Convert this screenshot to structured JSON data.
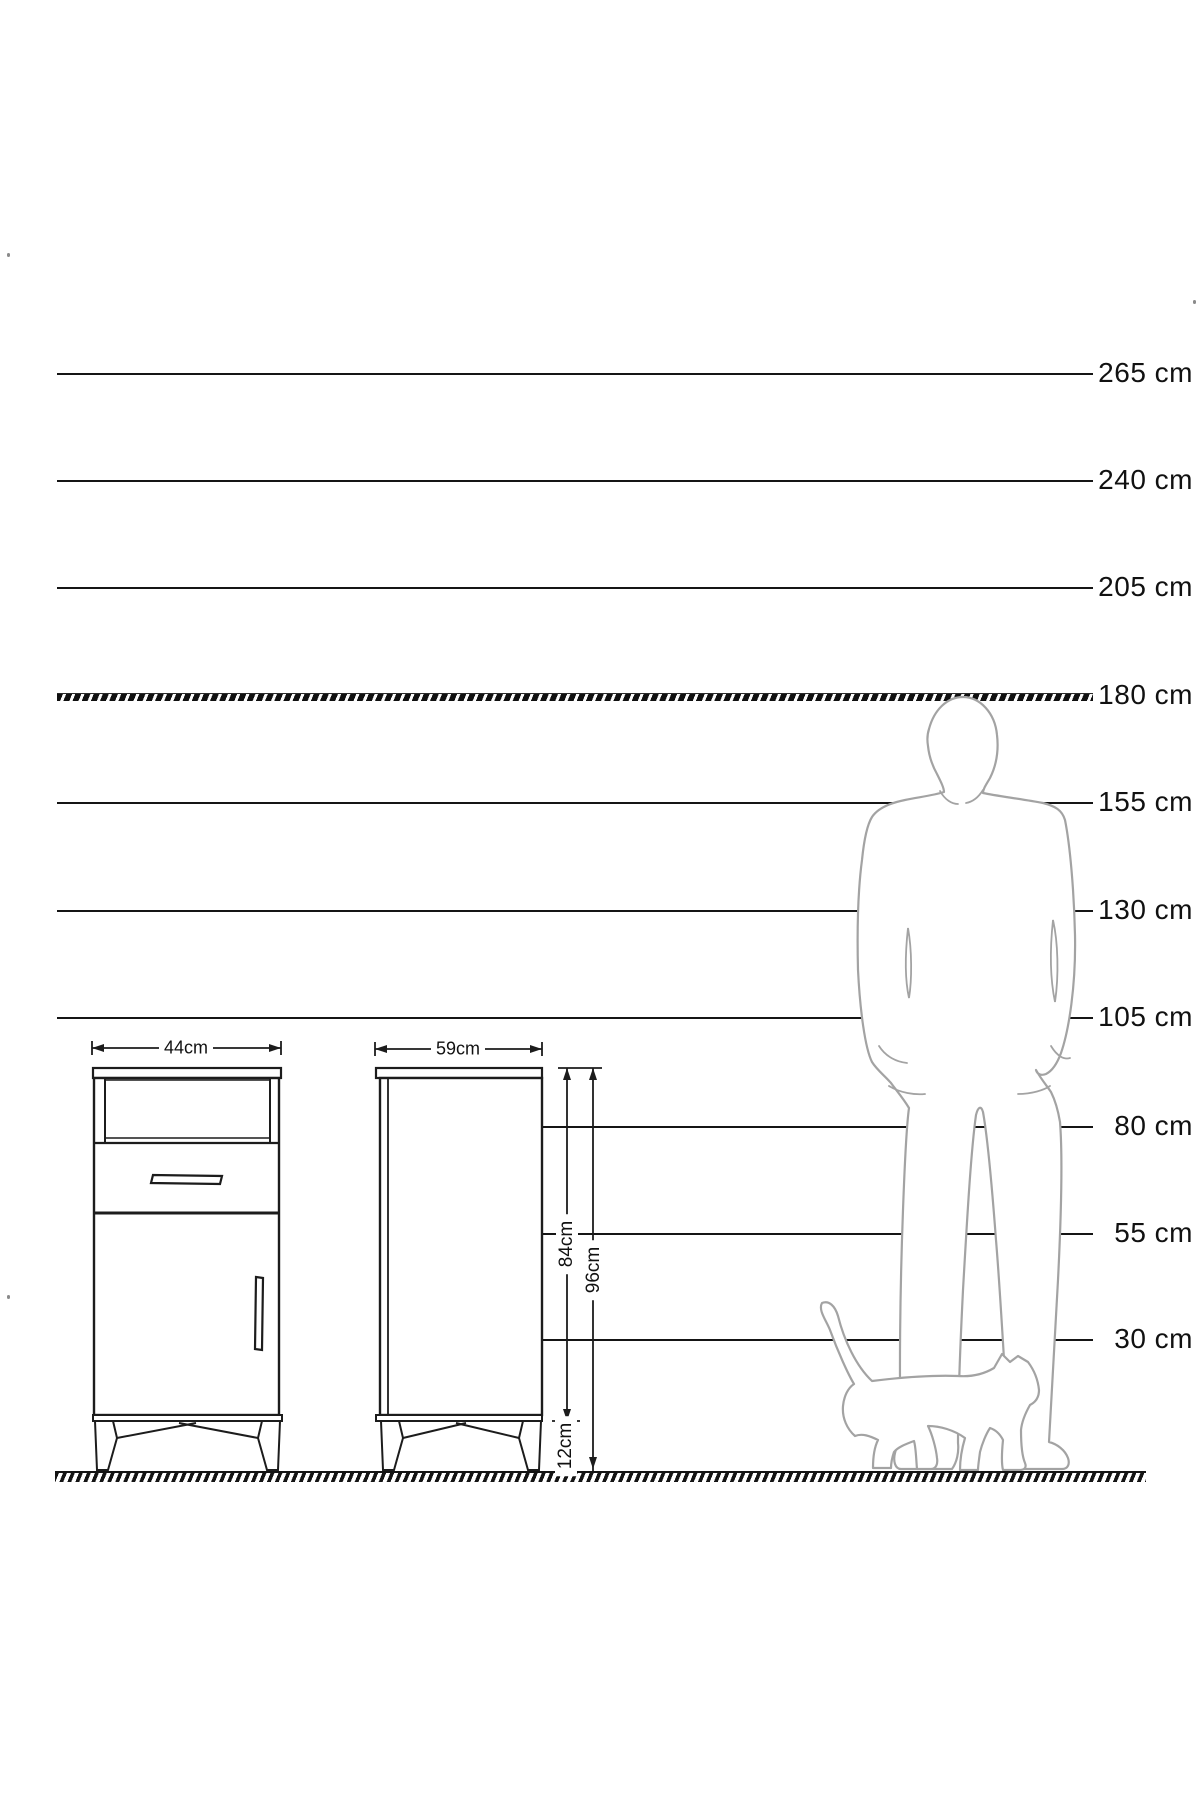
{
  "canvas": {
    "width": 1200,
    "height": 1800,
    "background": "#ffffff"
  },
  "colors": {
    "ink": "#1c1c1c",
    "figure_outline": "#a3a3a3"
  },
  "ruler": {
    "unit": "cm",
    "line_end_x": 1093,
    "label_right_x": 1193,
    "lines": [
      {
        "label": "265 cm",
        "value_cm": 265,
        "y": 374,
        "x1": 57,
        "style": "solid"
      },
      {
        "label": "240 cm",
        "value_cm": 240,
        "y": 481,
        "x1": 57,
        "style": "solid"
      },
      {
        "label": "205 cm",
        "value_cm": 205,
        "y": 588,
        "x1": 57,
        "style": "solid"
      },
      {
        "label": "180 cm",
        "value_cm": 180,
        "y": 696,
        "x1": 57,
        "style": "hatched"
      },
      {
        "label": "155 cm",
        "value_cm": 155,
        "y": 803,
        "x1": 57,
        "style": "solid"
      },
      {
        "label": "130 cm",
        "value_cm": 130,
        "y": 911,
        "x1": 57,
        "style": "solid"
      },
      {
        "label": "105 cm",
        "value_cm": 105,
        "y": 1018,
        "x1": 57,
        "style": "solid"
      },
      {
        "label": "80 cm",
        "value_cm": 80,
        "y": 1127,
        "x1": 542,
        "style": "solid"
      },
      {
        "label": "55 cm",
        "value_cm": 55,
        "y": 1234,
        "x1": 542,
        "style": "solid"
      },
      {
        "label": "30 cm",
        "value_cm": 30,
        "y": 1340,
        "x1": 542,
        "style": "solid"
      }
    ]
  },
  "ground": {
    "y": 1471,
    "x1": 55,
    "x2": 1146
  },
  "front_view": {
    "width_label": "44cm"
  },
  "side_view": {
    "width_label": "59cm",
    "body_height_label": "84cm",
    "total_height_label": "96cm",
    "leg_height_label": "12cm"
  }
}
